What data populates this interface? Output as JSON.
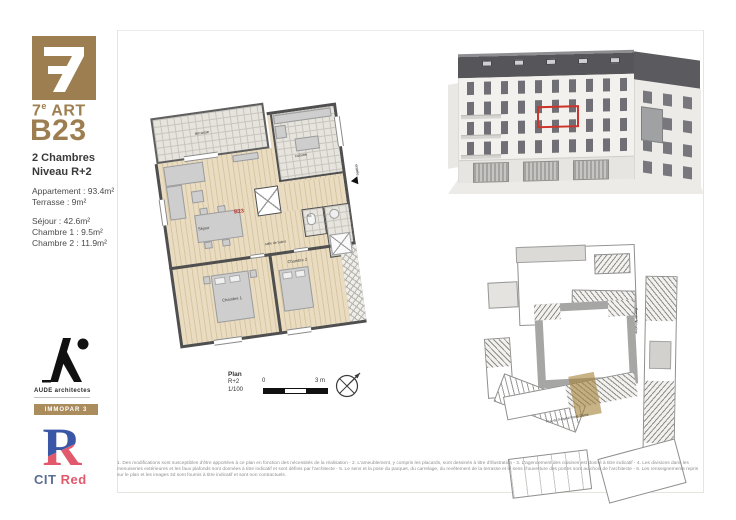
{
  "colors": {
    "gold": "#9d7e50",
    "accent_red": "#c0392b",
    "cit_blue": "#3a57a7",
    "cit_red": "#e2596b"
  },
  "sidebar": {
    "brand": {
      "prefix": "7",
      "sup": "e",
      "rest": " ART"
    },
    "unit_id": "B23",
    "unit_type": "2 Chambres",
    "unit_level": "Niveau R+2",
    "area_lines": [
      "Appartement : 93.4m²",
      "Terrasse : 9m²"
    ],
    "room_lines": [
      "Séjour : 42.6m²",
      "Chambre 1 : 9.5m²",
      "Chambre 2 : 11.9m²"
    ],
    "architect_name": "AUDE architectes",
    "immopar_label": "IMMOPAR 3",
    "cit": "CIT",
    "cit_suffix": "Red"
  },
  "plan": {
    "unit_label": "B23",
    "labels": {
      "terrasse": "terrasse",
      "cuisine": "cuisine",
      "sejour": "Séjour",
      "chambre1": "Chambre 1",
      "chambre2": "Chambre 2",
      "wc": "wc",
      "sdb": "salle de bains",
      "entree": "entrée"
    },
    "cartouche": {
      "title": "Plan",
      "level": "R+2",
      "scale": "1/100"
    },
    "scalebar": {
      "start": "0",
      "end": "3 m"
    }
  },
  "siteplan": {
    "street_bottom": "Rue de l'Hôpital Notre-Dame",
    "street_right": "Rue de l'Arbalète"
  },
  "footer": {
    "disclaimer": "1. Des modifications sont susceptibles d'être apportées à ce plan en fonction des nécessités de la réalisation - 2. L'ameublement, y compris les placards, sont dessinés à titre d'illustration - 3. L'agencement des cuisines est donné à titre indicatif - 4. Les divisions dans les menuiseries extérieures et les faux plafonds sont données à titre indicatif et sont définis par l'architecte - 5. Le sens et la pose du parquet, du carrelage, du revêtement de la terrasse et le sens d'ouverture des portes sont au choix de l'architecte - 6. Les renseignements repris sur le plan et les images 3d sont fournis à titre indicatif et sont non contractuels."
  }
}
